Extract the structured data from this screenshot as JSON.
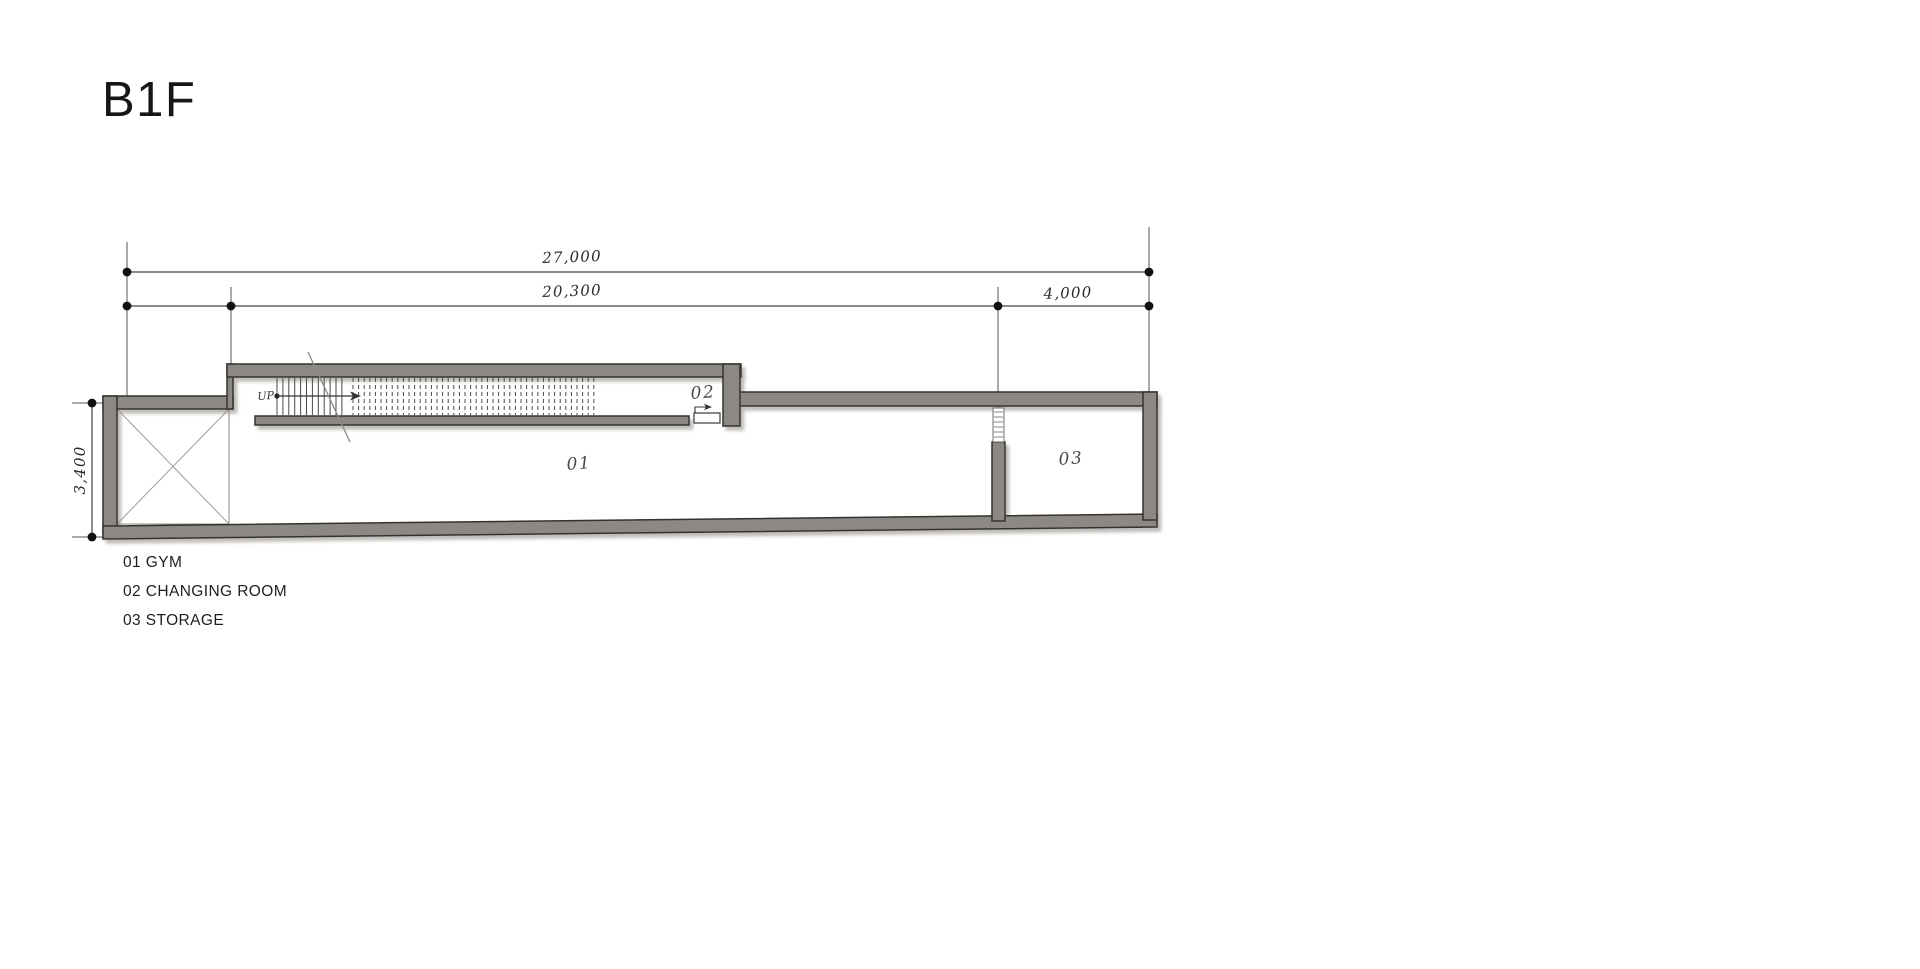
{
  "title": {
    "text": "B1F"
  },
  "floor_plan": {
    "dimensions": {
      "total_width": "27,000",
      "main_width": "20,300",
      "right_width": "4,000",
      "depth": "3,400"
    },
    "stair": {
      "direction_label": "UP"
    },
    "rooms": [
      {
        "number": "01",
        "name": "GYM"
      },
      {
        "number": "02",
        "name": "CHANGING ROOM"
      },
      {
        "number": "03",
        "name": "STORAGE"
      }
    ],
    "colors": {
      "wall_fill": "#8c8884",
      "wall_outline": "#35332f",
      "dimension_line": "#444444",
      "paper": "#ffffff"
    }
  }
}
